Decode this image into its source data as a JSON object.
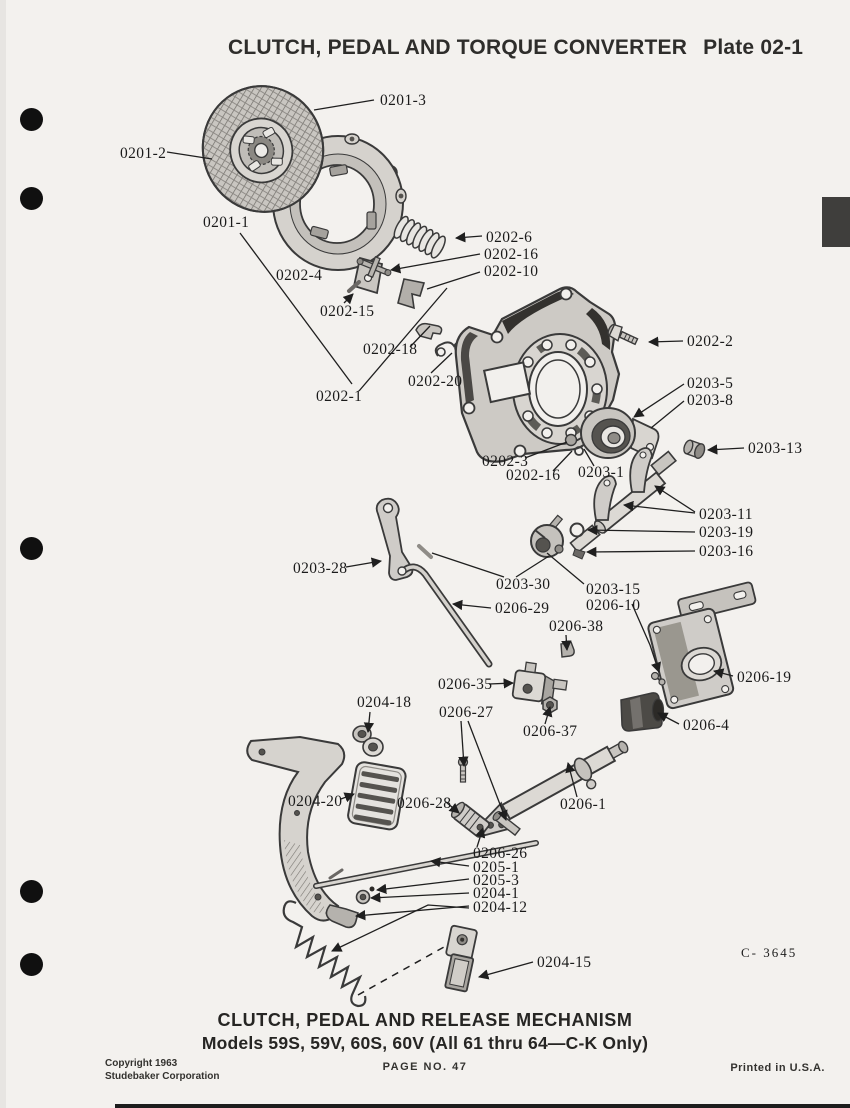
{
  "header": {
    "title": "CLUTCH, PEDAL AND TORQUE CONVERTER",
    "plate": "Plate 02-1"
  },
  "diagram": {
    "figure_code": "C- 3645",
    "part_labels": [
      {
        "text": "0201-3",
        "x": 380,
        "y": 105,
        "leaders": [
          {
            "pts": [
              [
                374,
                100
              ],
              [
                314,
                110
              ]
            ],
            "arrow": false
          }
        ]
      },
      {
        "text": "0201-2",
        "x": 120,
        "y": 158,
        "leaders": [
          {
            "pts": [
              [
                167,
                152
              ],
              [
                212,
                159
              ]
            ],
            "arrow": false
          }
        ]
      },
      {
        "text": "0201-1",
        "x": 203,
        "y": 227,
        "leaders": [
          {
            "pts": [
              [
                240,
                233
              ],
              [
                352,
                384
              ]
            ],
            "arrow": false
          }
        ]
      },
      {
        "text": "0202-4",
        "x": 276,
        "y": 280,
        "leaders": []
      },
      {
        "text": "0202-6",
        "x": 486,
        "y": 242,
        "leaders": [
          {
            "pts": [
              [
                482,
                236
              ],
              [
                456,
                238
              ]
            ],
            "arrow": true
          }
        ]
      },
      {
        "text": "0202-16",
        "x": 484,
        "y": 259,
        "leaders": [
          {
            "pts": [
              [
                480,
                254
              ],
              [
                391,
                270
              ]
            ],
            "arrow": true
          }
        ]
      },
      {
        "text": "0202-10",
        "x": 484,
        "y": 276,
        "leaders": [
          {
            "pts": [
              [
                480,
                272
              ],
              [
                427,
                289
              ]
            ],
            "arrow": false
          }
        ]
      },
      {
        "text": "0202-15",
        "x": 320,
        "y": 316,
        "leaders": [
          {
            "pts": [
              [
                344,
                303
              ],
              [
                353,
                294
              ]
            ],
            "arrow": true
          }
        ]
      },
      {
        "text": "0202-18",
        "x": 363,
        "y": 354,
        "leaders": [
          {
            "pts": [
              [
                410,
                347
              ],
              [
                430,
                326
              ]
            ],
            "arrow": false
          }
        ]
      },
      {
        "text": "0202-20",
        "x": 408,
        "y": 386,
        "leaders": [
          {
            "pts": [
              [
                431,
                373
              ],
              [
                452,
                353
              ]
            ],
            "arrow": false
          }
        ]
      },
      {
        "text": "0202-1",
        "x": 316,
        "y": 401,
        "leaders": [
          {
            "pts": [
              [
                359,
                391
              ],
              [
                447,
                288
              ]
            ],
            "arrow": false
          }
        ]
      },
      {
        "text": "0202-2",
        "x": 687,
        "y": 346,
        "leaders": [
          {
            "pts": [
              [
                683,
                341
              ],
              [
                649,
                342
              ]
            ],
            "arrow": true
          }
        ]
      },
      {
        "text": "0203-5",
        "x": 687,
        "y": 388,
        "leaders": [
          {
            "pts": [
              [
                684,
                384
              ],
              [
                634,
                417
              ]
            ],
            "arrow": true
          }
        ]
      },
      {
        "text": "0203-8",
        "x": 687,
        "y": 405,
        "leaders": [
          {
            "pts": [
              [
                684,
                401
              ],
              [
                651,
                428
              ]
            ],
            "arrow": false
          }
        ]
      },
      {
        "text": "0203-13",
        "x": 748,
        "y": 453,
        "leaders": [
          {
            "pts": [
              [
                744,
                448
              ],
              [
                708,
                450
              ]
            ],
            "arrow": true
          }
        ]
      },
      {
        "text": "0202-3",
        "x": 482,
        "y": 466,
        "leaders": [
          {
            "pts": [
              [
                525,
                458
              ],
              [
                567,
                442
              ]
            ],
            "arrow": false
          }
        ]
      },
      {
        "text": "0202-16",
        "x": 506,
        "y": 480,
        "leaders": [
          {
            "pts": [
              [
                553,
                471
              ],
              [
                572,
                451
              ]
            ],
            "arrow": false
          }
        ]
      },
      {
        "text": "0203-1",
        "x": 578,
        "y": 477,
        "leaders": [
          {
            "pts": [
              [
                594,
                466
              ],
              [
                584,
                449
              ]
            ],
            "arrow": false
          }
        ]
      },
      {
        "text": "0203-11",
        "x": 699,
        "y": 519,
        "leaders": [
          {
            "pts": [
              [
                695,
                513
              ],
              [
                624,
                505
              ]
            ],
            "arrow": true
          },
          {
            "pts": [
              [
                695,
                512
              ],
              [
                655,
                486
              ]
            ],
            "arrow": true
          }
        ]
      },
      {
        "text": "0203-19",
        "x": 699,
        "y": 537,
        "leaders": [
          {
            "pts": [
              [
                695,
                532
              ],
              [
                588,
                530
              ]
            ],
            "arrow": true
          }
        ]
      },
      {
        "text": "0203-16",
        "x": 699,
        "y": 556,
        "leaders": [
          {
            "pts": [
              [
                695,
                551
              ],
              [
                587,
                552
              ]
            ],
            "arrow": true
          }
        ]
      },
      {
        "text": "0203-30",
        "x": 496,
        "y": 589,
        "leaders": [
          {
            "pts": [
              [
                516,
                577
              ],
              [
                549,
                556
              ]
            ],
            "arrow": false
          },
          {
            "pts": [
              [
                504,
                577
              ],
              [
                432,
                553
              ]
            ],
            "arrow": false
          }
        ]
      },
      {
        "text": "0203-15",
        "x": 586,
        "y": 594,
        "leaders": [
          {
            "pts": [
              [
                584,
                584
              ],
              [
                547,
                553
              ]
            ],
            "arrow": false
          }
        ]
      },
      {
        "text": "0206-10",
        "x": 586,
        "y": 610,
        "leaders": [
          {
            "pts": [
              [
                632,
                604
              ],
              [
                650,
                645
              ],
              [
                659,
                672
              ]
            ],
            "arrow": true
          }
        ]
      },
      {
        "text": "0203-28",
        "x": 293,
        "y": 573,
        "leaders": [
          {
            "pts": [
              [
                346,
                567
              ],
              [
                381,
                561
              ]
            ],
            "arrow": true
          }
        ]
      },
      {
        "text": "0206-29",
        "x": 495,
        "y": 613,
        "leaders": [
          {
            "pts": [
              [
                491,
                608
              ],
              [
                453,
                604
              ]
            ],
            "arrow": true
          }
        ]
      },
      {
        "text": "0206-38",
        "x": 549,
        "y": 631,
        "leaders": [
          {
            "pts": [
              [
                566,
                635
              ],
              [
                567,
                650
              ]
            ],
            "arrow": true
          }
        ]
      },
      {
        "text": "0206-19",
        "x": 737,
        "y": 682,
        "leaders": [
          {
            "pts": [
              [
                733,
                676
              ],
              [
                714,
                671
              ]
            ],
            "arrow": true
          }
        ]
      },
      {
        "text": "0206-4",
        "x": 683,
        "y": 730,
        "leaders": [
          {
            "pts": [
              [
                679,
                724
              ],
              [
                658,
                713
              ]
            ],
            "arrow": true
          }
        ]
      },
      {
        "text": "0206-35",
        "x": 438,
        "y": 689,
        "leaders": [
          {
            "pts": [
              [
                489,
                684
              ],
              [
                513,
                683
              ]
            ],
            "arrow": true
          }
        ]
      },
      {
        "text": "0204-18",
        "x": 357,
        "y": 707,
        "leaders": [
          {
            "pts": [
              [
                370,
                712
              ],
              [
                368,
                732
              ]
            ],
            "arrow": true
          }
        ]
      },
      {
        "text": "0206-27",
        "x": 439,
        "y": 717,
        "leaders": [
          {
            "pts": [
              [
                461,
                721
              ],
              [
                464,
                766
              ]
            ],
            "arrow": true
          },
          {
            "pts": [
              [
                468,
                721
              ],
              [
                506,
                820
              ]
            ],
            "arrow": true
          }
        ]
      },
      {
        "text": "0206-37",
        "x": 523,
        "y": 736,
        "leaders": [
          {
            "pts": [
              [
                545,
                724
              ],
              [
                550,
                707
              ]
            ],
            "arrow": true
          }
        ]
      },
      {
        "text": "0206-28",
        "x": 397,
        "y": 808,
        "leaders": [
          {
            "pts": [
              [
                446,
                802
              ],
              [
                459,
                813
              ]
            ],
            "arrow": true
          }
        ]
      },
      {
        "text": "0206-1",
        "x": 560,
        "y": 809,
        "leaders": [
          {
            "pts": [
              [
                577,
                797
              ],
              [
                568,
                763
              ]
            ],
            "arrow": true
          }
        ]
      },
      {
        "text": "0204-20",
        "x": 288,
        "y": 806,
        "leaders": [
          {
            "pts": [
              [
                341,
                799
              ],
              [
                354,
                794
              ]
            ],
            "arrow": true
          }
        ]
      },
      {
        "text": "0206-26",
        "x": 473,
        "y": 858,
        "leaders": [
          {
            "pts": [
              [
                477,
                847
              ],
              [
                483,
                828
              ]
            ],
            "arrow": true
          }
        ]
      },
      {
        "text": "0205-1",
        "x": 473,
        "y": 872,
        "leaders": [
          {
            "pts": [
              [
                469,
                866
              ],
              [
                431,
                861
              ]
            ],
            "arrow": true
          }
        ]
      },
      {
        "text": "0205-3",
        "x": 473,
        "y": 885,
        "leaders": [
          {
            "pts": [
              [
                469,
                879
              ],
              [
                377,
                890
              ]
            ],
            "arrow": true
          }
        ]
      },
      {
        "text": "0204-1",
        "x": 473,
        "y": 898,
        "leaders": [
          {
            "pts": [
              [
                469,
                893
              ],
              [
                371,
                898
              ]
            ],
            "arrow": true
          }
        ]
      },
      {
        "text": "0204-12",
        "x": 473,
        "y": 912,
        "leaders": [
          {
            "pts": [
              [
                469,
                906
              ],
              [
                356,
                916
              ]
            ],
            "arrow": true
          },
          {
            "pts": [
              [
                469,
                908
              ],
              [
                428,
                905
              ],
              [
                332,
                951
              ]
            ],
            "arrow": true
          }
        ]
      },
      {
        "text": "0204-15",
        "x": 537,
        "y": 967,
        "leaders": [
          {
            "pts": [
              [
                533,
                962
              ],
              [
                479,
                977
              ]
            ],
            "arrow": true
          }
        ]
      },
      {
        "text": "C- 3645",
        "x": 741,
        "y": 957,
        "small": true,
        "leaders": []
      }
    ],
    "dashed_lines": [
      [
        [
          358,
          995
        ],
        [
          444,
          947
        ]
      ]
    ]
  },
  "footer": {
    "caption1": "CLUTCH, PEDAL AND RELEASE MECHANISM",
    "caption2": "Models 59S, 59V, 60S, 60V (All 61 thru 64—C-K Only)",
    "copyright1": "Copyright 1963",
    "copyright2": "Studebaker Corporation",
    "page_number": "PAGE NO. 47",
    "printed": "Printed in U.S.A."
  }
}
